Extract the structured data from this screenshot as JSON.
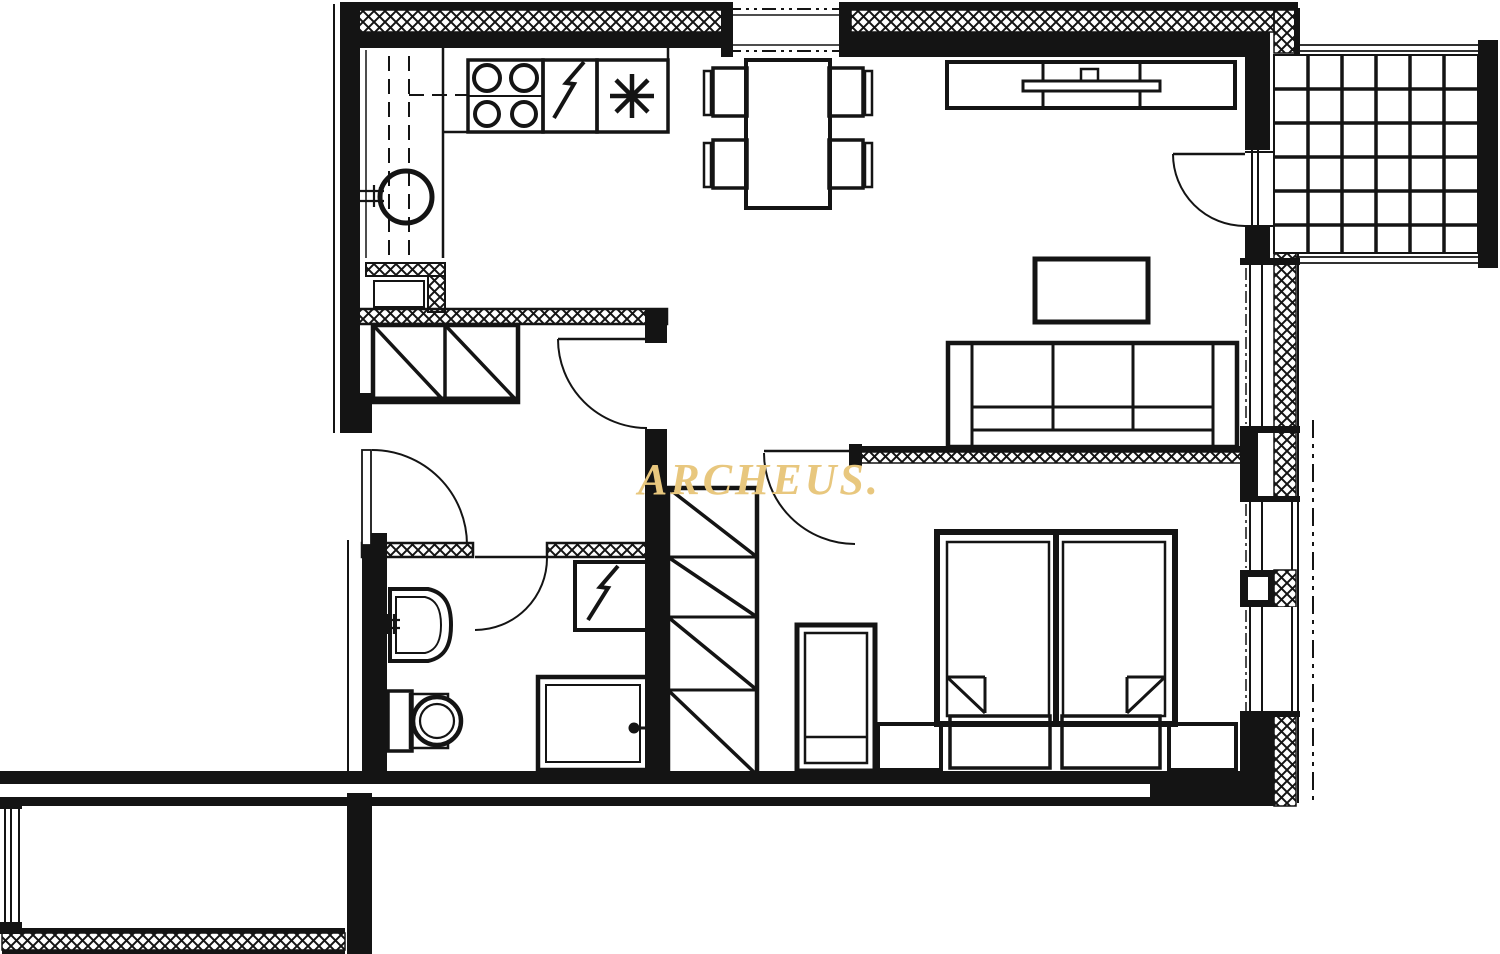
{
  "watermark": {
    "text": "ARCHEUS.",
    "color": "#E8C77E"
  },
  "colors": {
    "ink": "#141414",
    "background": "#FFFFFF",
    "watermark": "#E8C77E"
  },
  "plan": {
    "type": "apartment-floor-plan",
    "symbols": {
      "cooktop_icon": "four-burner-stove",
      "dishwasher_icon": "lightning-bolt",
      "freezer_icon": "asterisk-snowflake",
      "kitchen_sink_icon": "round-sink-with-faucet",
      "washing_machine_icon": "square-with-lightning-bolt",
      "bathroom_sink_icon": "bowed-basin-with-faucet",
      "toilet_icon": "cistern-and-round-bowl",
      "shower_icon": "nested-squares-with-drain-dot",
      "wardrobe_icon": "cells-with-diagonals",
      "insulation_hatch": "cross-hatched-wall-band",
      "window_icon": "double-glazing-lines",
      "door_icon": "quarter-circle-swing",
      "balcony_icon": "tile-grid",
      "bed_icon": "double-mattress-with-fold-corners",
      "property_line": "dash-dot-line"
    }
  }
}
